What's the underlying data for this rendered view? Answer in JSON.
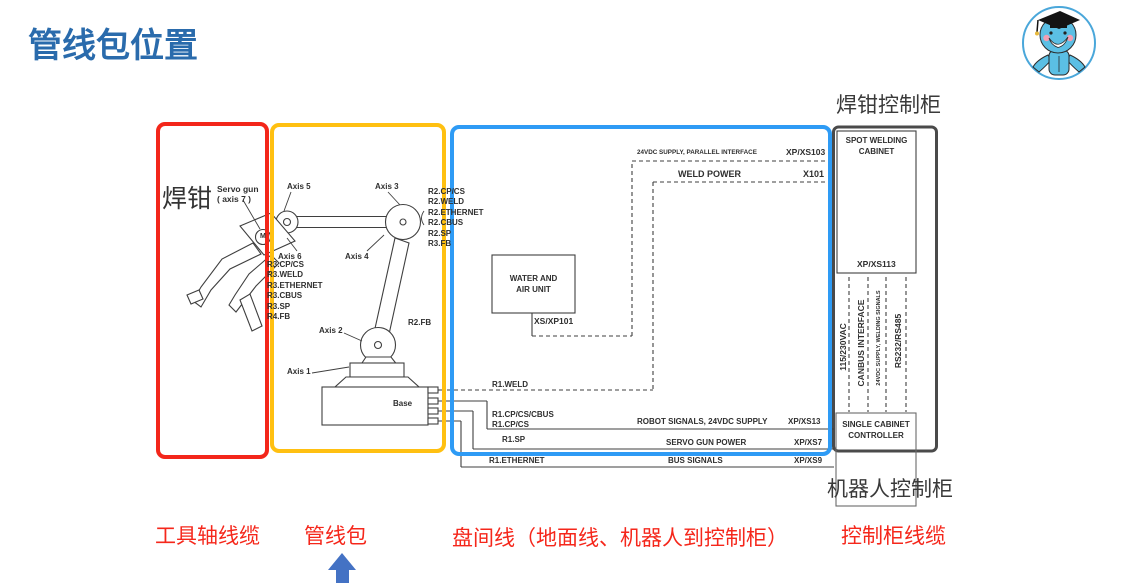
{
  "slide": {
    "title": "管线包位置"
  },
  "headings": {
    "gun_cabinet": "焊钳控制柜",
    "robot_cabinet": "机器人控制柜"
  },
  "legend": {
    "tool_axis_cable": "工具轴线缆",
    "dresspack": "管线包",
    "panel_lines": "盘间线（地面线、机器人到控制柜）",
    "cabinet_cable": "控制柜线缆"
  },
  "robot": {
    "gun": "焊钳",
    "servo_gun": "Servo gun",
    "servo_gun_axis": "( axis 7 )",
    "motor": "M",
    "base": "Base",
    "axis1": "Axis 1",
    "axis2": "Axis 2",
    "axis3": "Axis 3",
    "axis4": "Axis 4",
    "axis5": "Axis 5",
    "axis6": "Axis 6",
    "r2fb": "R2.FB",
    "r3_list": [
      "R3.CP/CS",
      "R3.WELD",
      "R3.ETHERNET",
      "R3.CBUS",
      "R3.SP",
      "R4.FB"
    ],
    "r2_list": [
      "R2.CP/CS",
      "R2.WELD",
      "R2.ETHERNET",
      "R2.CBUS",
      "R2.SP",
      "R3.FB"
    ]
  },
  "middle": {
    "water_air_unit": "WATER AND\nAIR UNIT",
    "xs_xp101": "XS/XP101",
    "supply_parallel": "24VDC SUPPLY, PARALLEL INTERFACE",
    "xp_xs103": "XP/XS103",
    "weld_power": "WELD POWER",
    "x101": "X101",
    "r1_weld": "R1.WELD",
    "r1_cpcscbus": "R1.CP/CS/CBUS",
    "r1_cpcs": "R1.CP/CS",
    "r1_sp": "R1.SP",
    "r1_ethernet": "R1.ETHERNET",
    "robot_signals": "ROBOT SIGNALS, 24VDC SUPPLY",
    "xp_xs13": "XP/XS13",
    "servo_gun_power": "SERVO GUN POWER",
    "xp_xs7": "XP/XS7",
    "bus_signals": "BUS SIGNALS",
    "xp_xs9": "XP/XS9"
  },
  "cabinet": {
    "spot_welding": "SPOT WELDING\nCABINET",
    "xp_xs113": "XP/XS113",
    "v115": "115/230VAC",
    "canbus": "CANBUS INTERFACE",
    "vdc24": "24VDC SUPPLY, WELDING SIGNALS",
    "rs232": "RS232/RS485",
    "controller": "SINGLE CABINET\nCONTROLLER"
  },
  "colors": {
    "title_blue": "#2a6bac",
    "highlight_red": "#f3261a",
    "highlight_yellow": "#ffc011",
    "highlight_blue": "#2e9bf5",
    "label_red": "#f5271b",
    "arrow_blue": "#4472c4",
    "line_gray": "#3f3f3f"
  }
}
